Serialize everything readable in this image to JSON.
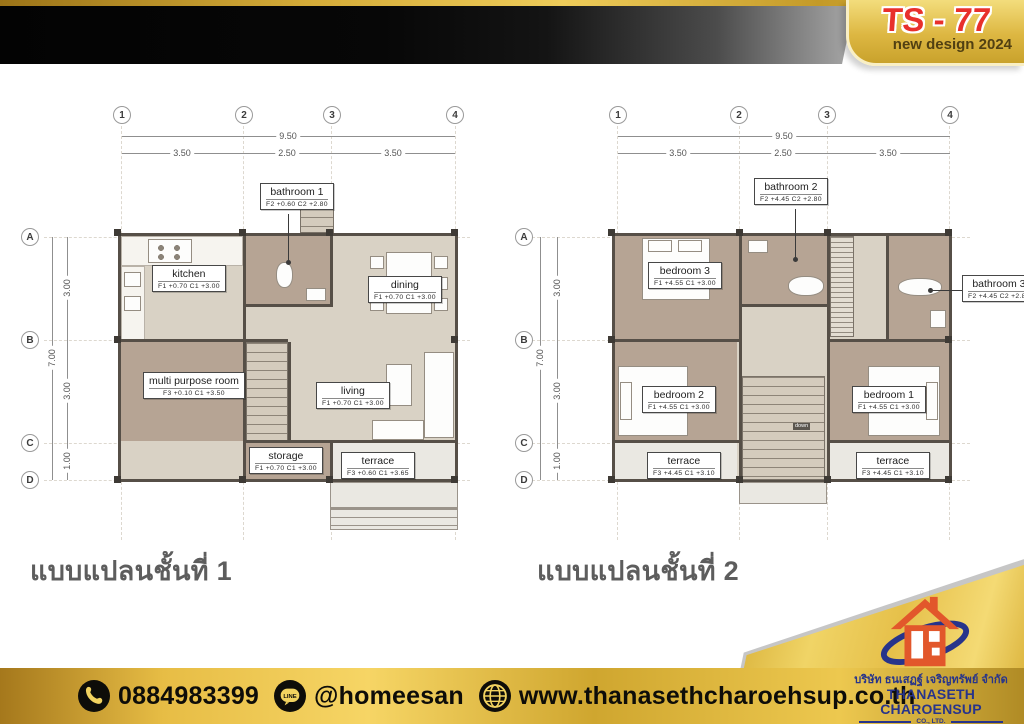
{
  "badge": {
    "model": "TS - 77",
    "subtitle": "new design 2024"
  },
  "grid": {
    "cols": [
      "1",
      "2",
      "3",
      "4"
    ],
    "rows": [
      "A",
      "B",
      "C",
      "D"
    ]
  },
  "dims": {
    "overall_w": "9.50",
    "spans_w": [
      "3.50",
      "2.50",
      "3.50"
    ],
    "overall_h": "7.00",
    "spans_h": [
      "3.00",
      "3.00",
      "1.00"
    ]
  },
  "floor1": {
    "caption": "แบบแปลนชั้นที่ 1",
    "rooms": {
      "kitchen": {
        "name": "kitchen",
        "level": "F1 +0.70 C1 +3.00"
      },
      "bathroom1": {
        "name": "bathroom 1",
        "level": "F2 +0.60 C2 +2.80"
      },
      "dining": {
        "name": "dining",
        "level": "F1 +0.70 C1 +3.00"
      },
      "multipurpose": {
        "name": "multi purpose room",
        "level": "F3 +0.10 C1 +3.50"
      },
      "living": {
        "name": "living",
        "level": "F1 +0.70 C1 +3.00"
      },
      "storage": {
        "name": "storage",
        "level": "F1 +0.70 C1 +3.00"
      },
      "terrace": {
        "name": "terrace",
        "level": "F3 +0.60 C1 +3.65"
      }
    }
  },
  "floor2": {
    "caption": "แบบแปลนชั้นที่ 2",
    "stair_note": "down",
    "rooms": {
      "bedroom3": {
        "name": "bedroom 3",
        "level": "F1 +4.55 C1 +3.00"
      },
      "bathroom2": {
        "name": "bathroom 2",
        "level": "F2 +4.45 C2 +2.80"
      },
      "bathroom3": {
        "name": "bathroom 3",
        "level": "F2 +4.45 C2 +2.80"
      },
      "bedroom2": {
        "name": "bedroom 2",
        "level": "F1 +4.55 C1 +3.00"
      },
      "bedroom1": {
        "name": "bedroom 1",
        "level": "F1 +4.55 C1 +3.00"
      },
      "terrace_left": {
        "name": "terrace",
        "level": "F3 +4.45 C1 +3.10"
      },
      "terrace_right": {
        "name": "terrace",
        "level": "F3 +4.45 C1 +3.10"
      }
    }
  },
  "footer": {
    "phone": "0884983399",
    "line_id": "@homeesan",
    "website": "www.thanasethcharoehsup.co.th"
  },
  "company": {
    "name_thai": "บริษัท ธนเสฏฐ์ เจริญทรัพย์ จำกัด",
    "name_en": "THANASETH CHAROENSUP",
    "suffix": "CO., LTD."
  },
  "colors": {
    "gold": "#d8ab33",
    "accent_red": "#e62b28",
    "navy": "#27348b",
    "orange": "#e2572b",
    "room_dark": "#b6a494",
    "room_light": "#d9d2c5",
    "terrace": "#eae8e2"
  }
}
